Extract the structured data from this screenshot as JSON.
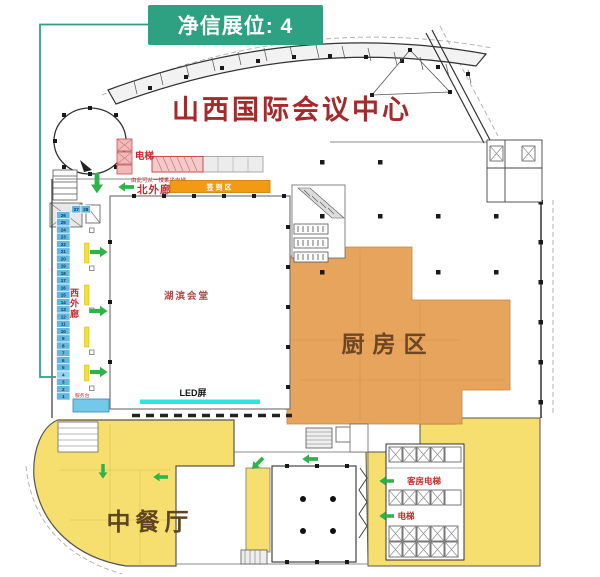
{
  "badge": {
    "label": "净信展位: 4"
  },
  "map": {
    "title": "山西国际会议中心",
    "hall_label": "湖滨会堂",
    "kitchen_label": "厨房区",
    "restaurant_label": "中餐厅",
    "led_label": "LED屏",
    "north_corridor_label": "北外廊",
    "west_corridor_chars": [
      "西",
      "外",
      "廊"
    ],
    "checkin_label": "签到区",
    "elevator_label": "电梯",
    "elevator_note": "由此可从一楼乘坐电梯",
    "guest_elevator_label": "客房电梯",
    "south_elevator_label": "电梯",
    "desk_label": "服务台",
    "booths": {
      "top_row": [
        "27",
        "28"
      ],
      "column_top_to_bottom": [
        "26",
        "25",
        "24",
        "23",
        "22",
        "21",
        "20",
        "19",
        "18",
        "17",
        "16",
        "15",
        "14",
        "13",
        "12",
        "11",
        "10",
        "9",
        "8",
        "7",
        "6",
        "5",
        "4",
        "3",
        "2",
        "1"
      ],
      "highlighted_booth": "4"
    }
  },
  "colors": {
    "badge_green": "#2EA183",
    "title_red": "#A6292B",
    "label_red": "#C22B2B",
    "kitchen_orange": "#E6A45C",
    "zone_yellow": "#F6DF6F",
    "booth_blue": "#62B8E0",
    "booth_text": "#0B3B66",
    "led_cyan": "#2BE8DE",
    "checkin_orange": "#F09B13",
    "arrow_green": "#2EB34A",
    "desk_blue": "#74C8EA",
    "stage_pink": "#F4CACA"
  }
}
